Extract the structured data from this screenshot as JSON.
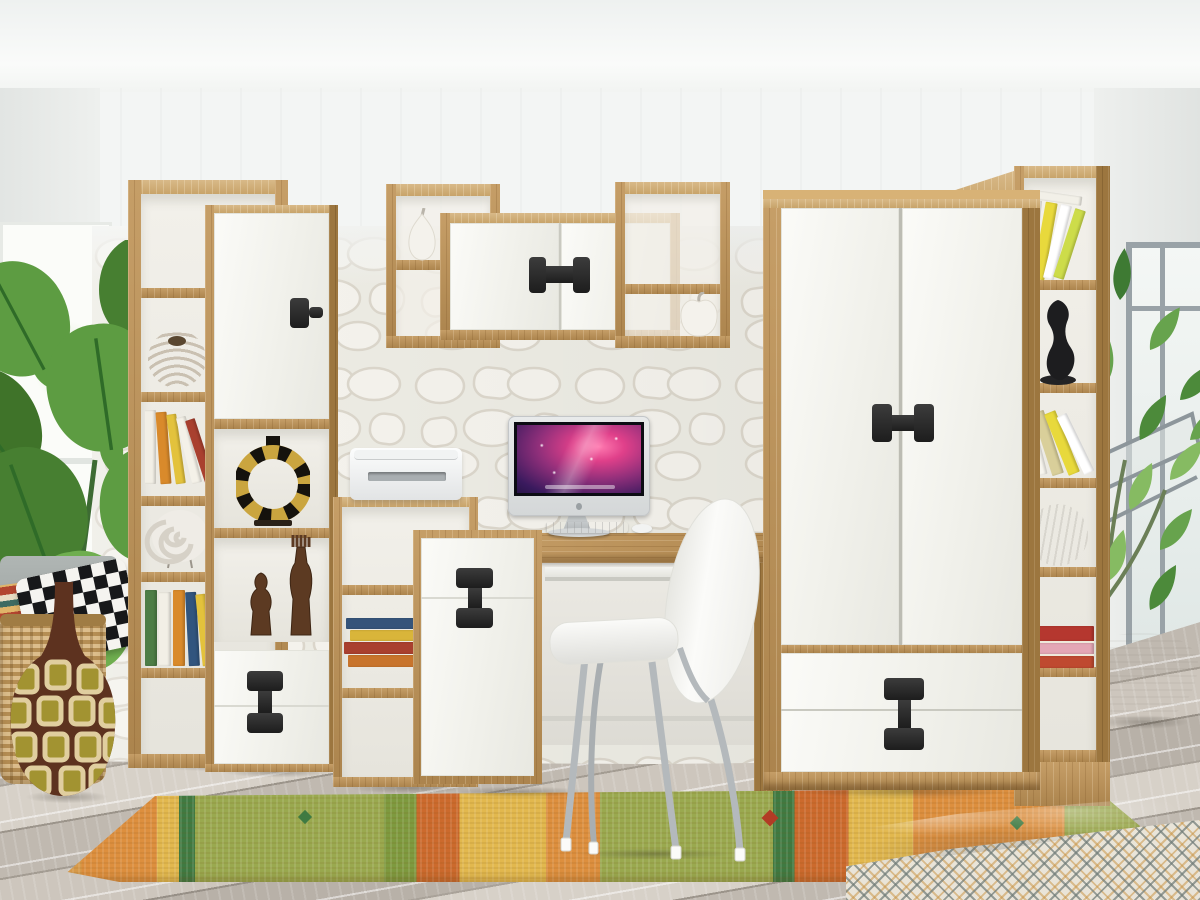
{
  "scene": {
    "description": "3D product render of a teen-room furniture wall set in artisan oak with white gloss fronts and black H/I-shaped handles: bookcases, wall shelves, desk with computer, wardrobe, decorated room",
    "room": {
      "ceiling": "white",
      "accent_wall": "white 3D stone-pattern panel wall",
      "floor": "whitewashed grey wood planks",
      "left_window": "bright window behind monstera plant",
      "right_window": "grey-framed window with open casement"
    }
  },
  "objects": {
    "left_bookcase": "tall open bookcase, oak",
    "display_column": "display column: white door, two open niches, two drawers",
    "wall_shelf_left": "open wall shelf, oak",
    "wall_cabinet": "two-door wall cabinet with black H-handle",
    "wall_shelf_right": "open wall shelf, oak",
    "ladder_shelf": "low open shelf unit, oak",
    "printer": "white printer",
    "desk": "desk with oak top and pull-out keyboard tray",
    "desk_pedestal": "desk cabinet, white drawer and door with black I-handle",
    "computer": "all-in-one computer, purple galaxy wallpaper",
    "keyboard": "white keyboard",
    "mouse": "white mouse",
    "chair": "white shell chair with chrome legs",
    "wardrobe": "two-door wardrobe with two drawers, black H/I handles",
    "right_bookcase": "tall narrow bookcase, oak",
    "monstera": "monstera plant",
    "potted_tree": "potted tree in white planter",
    "floor_vase": "brown gourd floor vase with square pattern",
    "basket": "wicker basket",
    "pillow_kilim": "striped kilim pillow",
    "pillow_chevron": "black-white chevron pillow",
    "rug": "orange-green kilim runner rug",
    "bed": "bed with grey blanket and patterned duvet",
    "woven_ball": "rattan ball ornament",
    "seashell": "white spiral shell on stand",
    "ethnic_ring": "gold-black ring ornament",
    "wooden_figurines": "carved wooden figurines",
    "black_figurine": "black abstract figurine",
    "white_ball": "white woven sphere",
    "pear_figurine": "white ceramic pear",
    "apple_figurine": "white ceramic apple",
    "books": "colorful books"
  },
  "colors": {
    "oak": "#bf9356",
    "oakLight": "#d0aa6e",
    "oakDark": "#9c763f",
    "front": "#f7f7f2",
    "handle": "#2a2a2a",
    "wall": "#f3f5f4",
    "accentWall": "#ecebe3",
    "floor": "#c9c2b9",
    "rugOrange": "#dd8f3e",
    "rugGreen": "#9aa94f",
    "rugGreenDark": "#3f7a42",
    "rugRed": "#cc6a2d",
    "rugYellow": "#e2b84e",
    "plant": "#55923d",
    "chrome": "#b6babd",
    "screenMagenta": "#e0408a",
    "screenDark": "#140d2e",
    "blanket": "#a8adb0",
    "duvet": "#e9e4d8",
    "vaseBrown": "#6e3b22",
    "basket": "#c9a266"
  }
}
